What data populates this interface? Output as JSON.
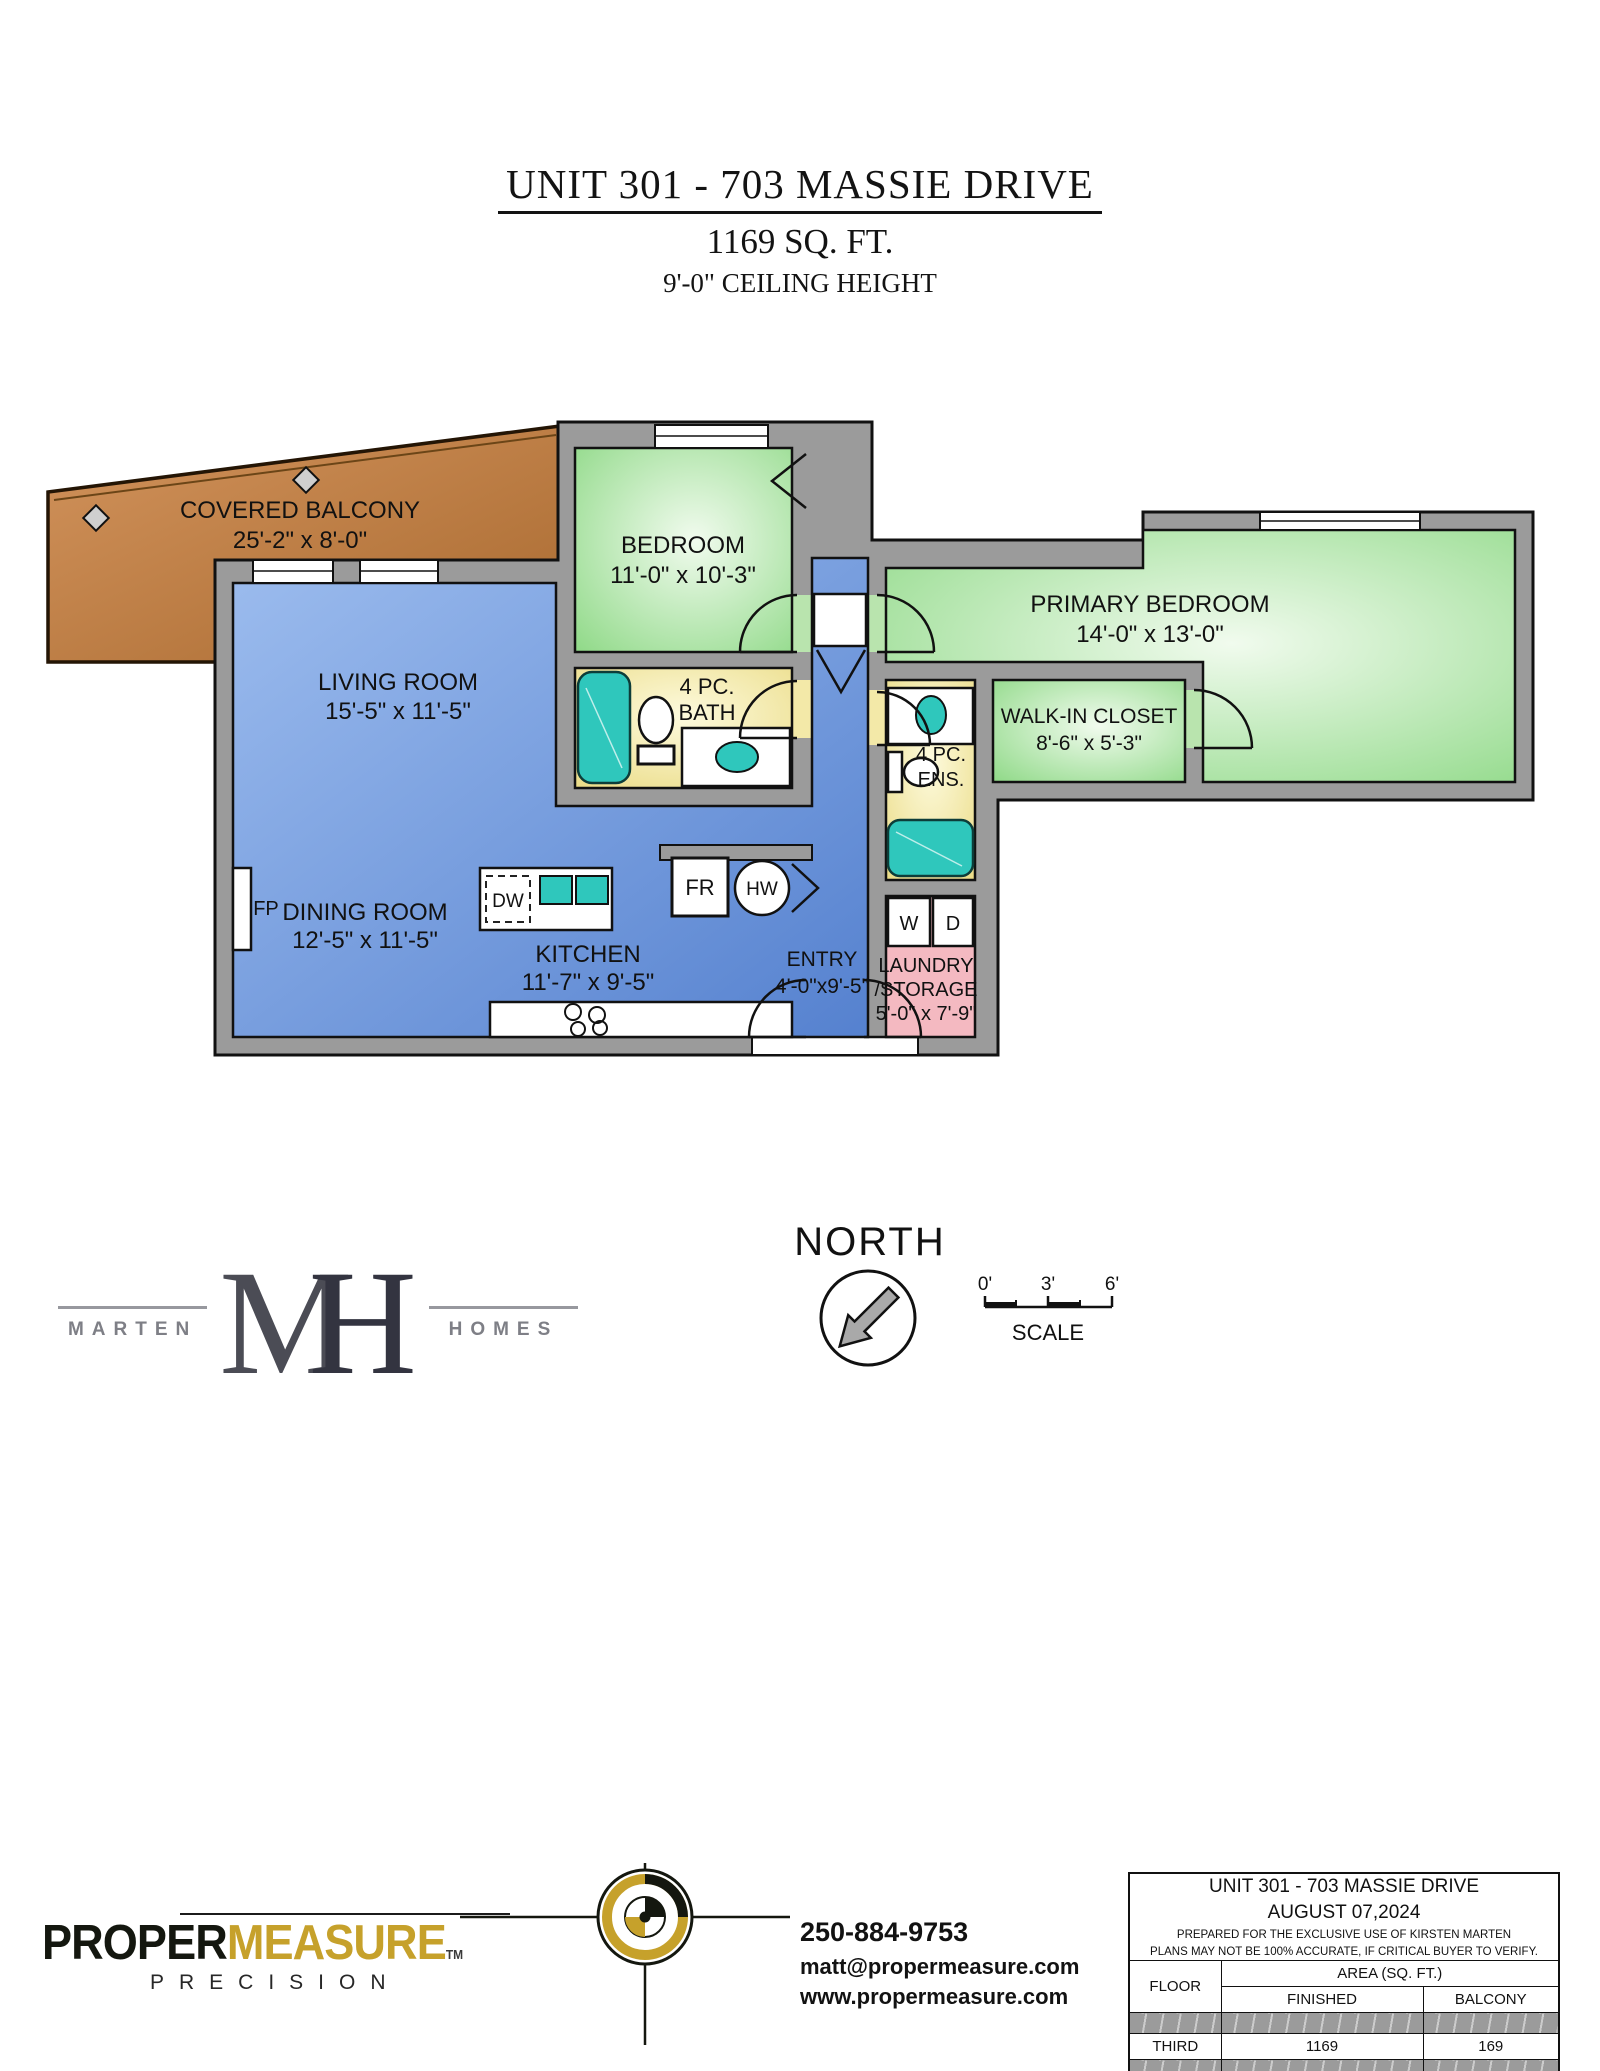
{
  "header": {
    "title": "UNIT 301 - 703 MASSIE DRIVE",
    "area": "1169 SQ. FT.",
    "ceiling": "9'-0\" CEILING HEIGHT"
  },
  "rooms": {
    "balcony": {
      "name": "COVERED BALCONY",
      "dims": "25'-2\" x 8'-0\""
    },
    "living": {
      "name": "LIVING ROOM",
      "dims": "15'-5\" x 11'-5\""
    },
    "dining": {
      "name": "DINING ROOM",
      "dims": "12'-5\" x 11'-5\""
    },
    "kitchen": {
      "name": "KITCHEN",
      "dims": "11'-7\" x 9'-5\""
    },
    "bedroom": {
      "name": "BEDROOM",
      "dims": "11'-0\" x 10'-3\""
    },
    "primary": {
      "name": "PRIMARY BEDROOM",
      "dims": "14'-0\" x 13'-0\""
    },
    "bath": {
      "line1": "4 PC.",
      "line2": "BATH"
    },
    "ensuite": {
      "line1": "4 PC.",
      "line2": "ENS."
    },
    "walkin": {
      "name": "WALK-IN CLOSET",
      "dims": "8'-6\" x 5'-3\""
    },
    "entry": {
      "name": "ENTRY",
      "dims": "4'-0\"x9'-5\""
    },
    "laundry": {
      "line1": "LAUNDRY",
      "line2": "/STORAGE",
      "dims": "5'-0\" x 7'-9\""
    }
  },
  "fixtures": {
    "fp": "FP",
    "dw": "DW",
    "fr": "FR",
    "hw": "HW",
    "washer": "W",
    "dryer": "D"
  },
  "compass": {
    "label": "NORTH"
  },
  "scalebar": {
    "t0": "0'",
    "t3": "3'",
    "t6": "6'",
    "label": "SCALE"
  },
  "marten_logo": {
    "left": "MARTEN",
    "mono_m": "M",
    "mono_h": "H",
    "right": "HOMES"
  },
  "propermeasure_logo": {
    "word1": "PROPER",
    "word2": "MEASURE",
    "tm": "TM",
    "tagline": "PRECISION"
  },
  "contact": {
    "phone": "250-884-9753",
    "email": "matt@propermeasure.com",
    "web": "www.propermeasure.com"
  },
  "title_block": {
    "line1": "UNIT 301 - 703 MASSIE DRIVE",
    "line2": "AUGUST 07,2024",
    "line3": "PREPARED FOR THE EXCLUSIVE USE OF KIRSTEN MARTEN",
    "line4": "PLANS MAY NOT BE 100% ACCURATE, IF CRITICAL BUYER TO VERIFY.",
    "col_floor": "FLOOR",
    "col_area": "AREA (SQ. FT.)",
    "col_finished": "FINISHED",
    "col_balcony": "BALCONY",
    "row_floor": "THIRD",
    "row_finished": "1169",
    "row_balcony": "169"
  },
  "colors": {
    "wall": "#9b9b9b",
    "bedroom_green": "#8cd884",
    "living_blue": "#5581cf",
    "bath_yellow": "#eada7f",
    "laundry_pink": "#f4b9c1",
    "balcony_brown": "#b87a3e",
    "fixture_teal": "#2fc7bc",
    "logo_gold": "#c6a12b"
  }
}
